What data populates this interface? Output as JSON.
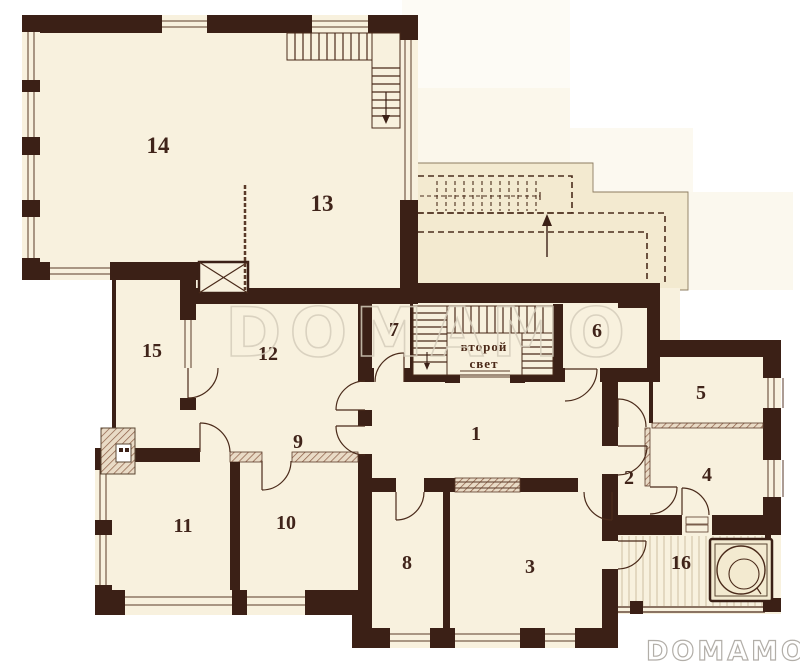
{
  "document": {
    "type": "floor-plan",
    "language": "ru"
  },
  "room_numbers": [
    "1",
    "2",
    "3",
    "4",
    "5",
    "6",
    "7",
    "8",
    "9",
    "10",
    "11",
    "12",
    "13",
    "14",
    "15",
    "16"
  ],
  "labels": {
    "second_light_line1": "второй",
    "second_light_line2": "свет"
  },
  "watermark": {
    "center_text": "DOMAMO",
    "logo_text": "DOMAMO"
  },
  "colors": {
    "wall": "#3b2016",
    "thin_line": "#4a2a1a",
    "room_fill": "#f8f1de",
    "upper_terrace_fill": "#f3ead0",
    "watermark_center": "#d5cdbb",
    "watermark_logo": "#b2aea8",
    "background": "#ffffff"
  }
}
